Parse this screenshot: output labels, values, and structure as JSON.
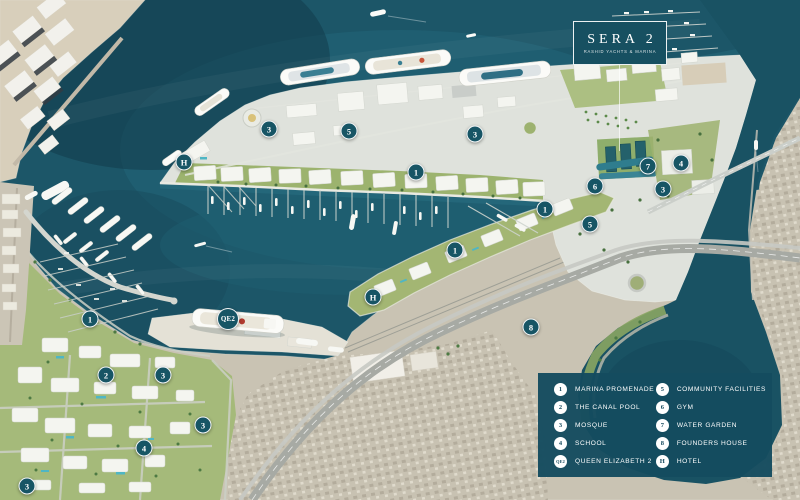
{
  "logo": {
    "title": "SERA 2",
    "subtitle": "RASHID YACHTS & MARINA"
  },
  "legend": {
    "columns": [
      {
        "items": [
          {
            "num": "1",
            "label": "MARINA PROMENADE"
          },
          {
            "num": "2",
            "label": "THE CANAL POOL"
          },
          {
            "num": "3",
            "label": "MOSQUE"
          },
          {
            "num": "4",
            "label": "SCHOOL"
          },
          {
            "num": "QE2",
            "label": "QUEEN ELIZABETH 2"
          }
        ]
      },
      {
        "items": [
          {
            "num": "5",
            "label": "COMMUNITY FACILITIES"
          },
          {
            "num": "6",
            "label": "GYM"
          },
          {
            "num": "7",
            "label": "WATER GARDEN"
          },
          {
            "num": "8",
            "label": "FOUNDERS HOUSE"
          },
          {
            "num": "H",
            "label": "HOTEL"
          }
        ]
      }
    ]
  },
  "map": {
    "markers": [
      {
        "label": "H",
        "x": 184,
        "y": 162
      },
      {
        "label": "3",
        "x": 269,
        "y": 129
      },
      {
        "label": "5",
        "x": 349,
        "y": 131
      },
      {
        "label": "1",
        "x": 416,
        "y": 172
      },
      {
        "label": "3",
        "x": 475,
        "y": 134
      },
      {
        "label": "7",
        "x": 648,
        "y": 166
      },
      {
        "label": "4",
        "x": 681,
        "y": 163
      },
      {
        "label": "6",
        "x": 595,
        "y": 186
      },
      {
        "label": "3",
        "x": 663,
        "y": 189
      },
      {
        "label": "1",
        "x": 545,
        "y": 209
      },
      {
        "label": "5",
        "x": 590,
        "y": 224
      },
      {
        "label": "1",
        "x": 455,
        "y": 250
      },
      {
        "label": "H",
        "x": 373,
        "y": 297
      },
      {
        "label": "8",
        "x": 531,
        "y": 327
      },
      {
        "label": "QE2",
        "x": 228,
        "y": 319
      },
      {
        "label": "1",
        "x": 90,
        "y": 319
      },
      {
        "label": "2",
        "x": 106,
        "y": 375
      },
      {
        "label": "3",
        "x": 163,
        "y": 375
      },
      {
        "label": "3",
        "x": 203,
        "y": 425
      },
      {
        "label": "4",
        "x": 144,
        "y": 448
      },
      {
        "label": "3",
        "x": 27,
        "y": 486
      }
    ]
  },
  "colors": {
    "brand_teal": "#175565",
    "legend_panel": "#154c5f",
    "water": "#1c5668",
    "marker_text": "#ffffff"
  }
}
